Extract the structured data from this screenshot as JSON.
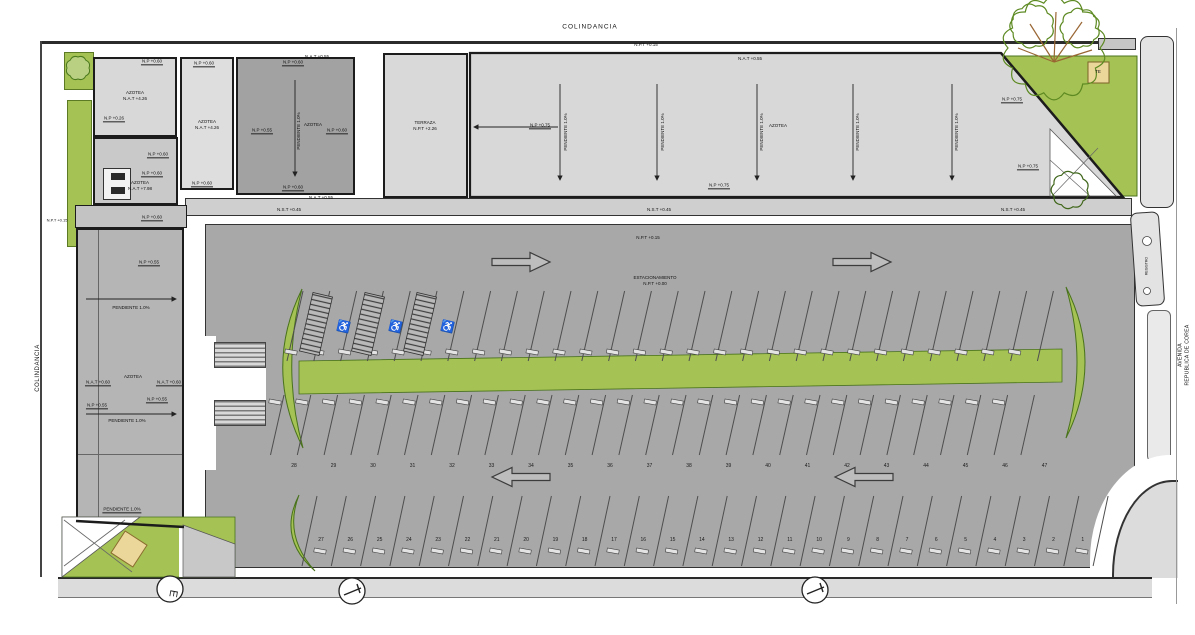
{
  "site": {
    "colindancia_top": "COLINDANCIA",
    "colindancia_left": "COLINDANCIA",
    "avenida_line1": "AVENIDA",
    "avenida_line2": "REPUBLICA DE COREA",
    "registro": "REGISTRO",
    "te_box": "TE"
  },
  "parking": {
    "title": "ESTACIONAMIENTO",
    "title_level": "N.P.T +0.00",
    "surface_level": "N.P.T +0.15",
    "top_boundary_level": "N.P.T +0.15",
    "west_edge_level": "N.P.T +0.15",
    "middle_row_numbers": [
      "28",
      "29",
      "30",
      "31",
      "32",
      "33",
      "34",
      "35",
      "36",
      "37",
      "38",
      "39",
      "40",
      "41",
      "42",
      "43",
      "44",
      "45",
      "46",
      "47"
    ],
    "bottom_row_numbers": [
      "27",
      "26",
      "25",
      "24",
      "23",
      "22",
      "21",
      "20",
      "19",
      "18",
      "17",
      "16",
      "15",
      "14",
      "13",
      "12",
      "11",
      "10",
      "9",
      "8",
      "7",
      "6",
      "5",
      "4",
      "3",
      "2",
      "1"
    ],
    "handicap_spaces": 3
  },
  "levels": {
    "np_075": "N.P +0.75",
    "np_060": "N.P +0.60",
    "np_055": "N.P +0.55",
    "np_026": "N.P +0.26",
    "nat_426": "N.A.T +4.26",
    "nat_798": "N.A.T +7.98",
    "nat_055": "N.A.T +0.55",
    "nat_060": "N.A.T +0.60",
    "nst_045": "N.S.T +0.45",
    "npt_226": "N.P.T +2.26"
  },
  "roof_labels": {
    "azotea": "AZOTEA",
    "terraza": "TERRAZA",
    "pendiente": "PENDIENTE 1.0%"
  },
  "colors": {
    "plan_green": "#a5c254",
    "asphalt": "#a8a8a8",
    "roof_light": "#d8d8d8",
    "roof_medium": "#c9c9c9",
    "roof_dark": "#a2a2a2",
    "street": "#dcdcdc",
    "outline": "#1c1c1c",
    "tan": "#ecd79b"
  }
}
